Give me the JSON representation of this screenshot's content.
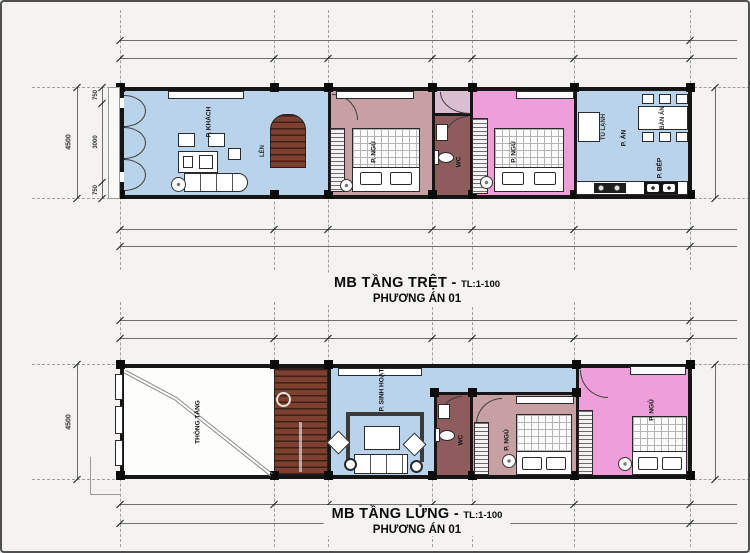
{
  "colors": {
    "page_background": "#f4f3f1",
    "living_blue": "#b9d4ea",
    "bedroom_mauve": "#c7a0a3",
    "bedroom_pink": "#ee9ed9",
    "wc_maroon": "#8e5c5c",
    "stair_brown": "#7c4030",
    "wall_black": "#161616"
  },
  "plans": [
    {
      "title": "MB TẦNG TRỆT",
      "separator": "-",
      "scale": "TL:1-100",
      "subtitle": "PHƯƠNG ÁN 01",
      "rooms": {
        "living": "P. KHÁCH",
        "bedroom_front": "P. NGỦ",
        "wc": "WC",
        "bedroom_middle": "P. NGỦ",
        "dining": "P. ĂN",
        "kitchen": "P. BẾP"
      },
      "furniture": {
        "dining_table": "BÀN ĂN",
        "fridge": "TỦ LẠNH",
        "stairs_up": "LÊN"
      },
      "dimensions": {
        "overall_depth": "4500",
        "front_setback": "750",
        "main_span": "3000",
        "rear_setback": "750"
      }
    },
    {
      "title": "MB TẦNG LỬNG",
      "separator": "-",
      "scale": "TL:1-100",
      "subtitle": "PHƯƠNG ÁN 01",
      "rooms": {
        "void": "THÔNG TẦNG",
        "family": "P. SINH HOẠT",
        "wc": "WC",
        "bedroom_middle": "P. NGỦ",
        "bedroom_rear": "P. NGỦ"
      },
      "dimensions": {
        "overall_depth": "4500"
      }
    }
  ]
}
